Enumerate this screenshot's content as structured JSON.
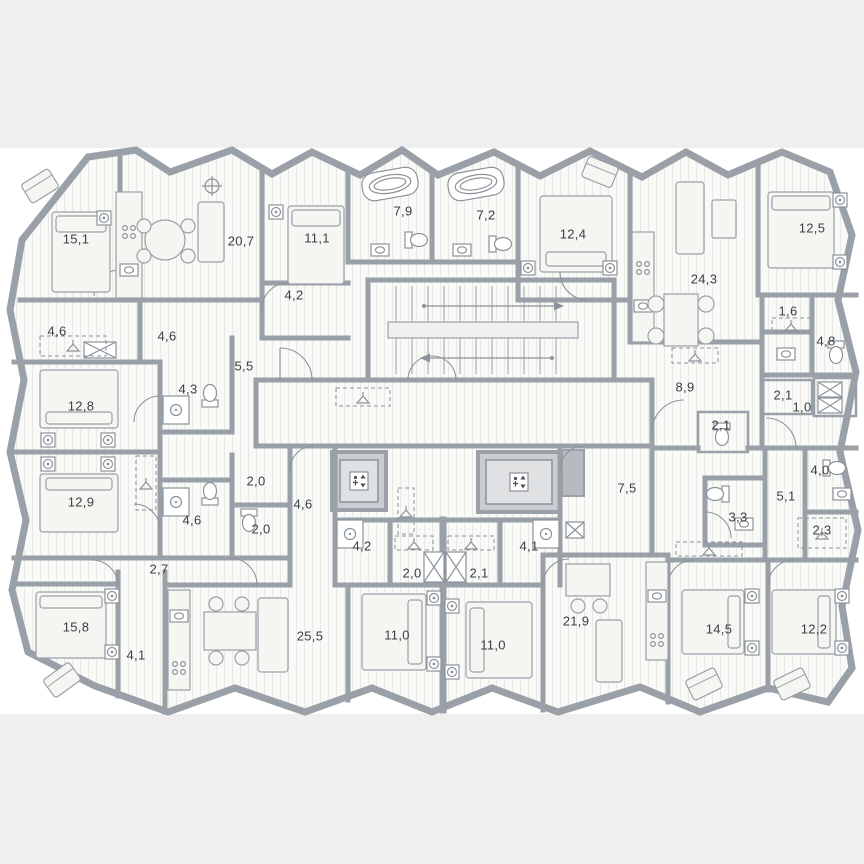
{
  "plan": {
    "type": "residential-floor-plan",
    "colors": {
      "background": "#efefef",
      "paper": "#ffffff",
      "wall": "#99a0a7",
      "floor": "#f9f9f7",
      "floor_stripe": "#e8e8e5",
      "corridor": "#dcdee1",
      "corridor_grid": "#d2d5d9",
      "furniture_fill": "#f5f5f2",
      "fixture_stroke": "#8c939a",
      "label": "#3a3f45"
    },
    "icons": {
      "elevator": "elevator-icon",
      "staircase": "staircase-icon",
      "bathtub": "bathtub-icon",
      "shower": "shower-icon",
      "toilet": "toilet-icon",
      "washbasin": "washbasin-icon",
      "stove": "stove-burners-icon",
      "wardrobe": "hanger-icon",
      "shaft": "crossed-shaft-icon",
      "ceiling_light": "ceiling-light-icon"
    },
    "rooms": [
      {
        "area": "15,1",
        "x": 76,
        "y": 240
      },
      {
        "area": "20,7",
        "x": 241,
        "y": 242
      },
      {
        "area": "11,1",
        "x": 317,
        "y": 239
      },
      {
        "area": "7,9",
        "x": 403,
        "y": 212
      },
      {
        "area": "7,2",
        "x": 486,
        "y": 216
      },
      {
        "area": "12,4",
        "x": 573,
        "y": 235
      },
      {
        "area": "24,3",
        "x": 704,
        "y": 280
      },
      {
        "area": "12,5",
        "x": 812,
        "y": 229
      },
      {
        "area": "4,6",
        "x": 57,
        "y": 332
      },
      {
        "area": "4,6",
        "x": 167,
        "y": 337
      },
      {
        "area": "4,2",
        "x": 294,
        "y": 296
      },
      {
        "area": "5,5",
        "x": 244,
        "y": 367
      },
      {
        "area": "4,3",
        "x": 188,
        "y": 390
      },
      {
        "area": "1,6",
        "x": 788,
        "y": 312
      },
      {
        "area": "4,8",
        "x": 826,
        "y": 342
      },
      {
        "area": "12,8",
        "x": 81,
        "y": 407
      },
      {
        "area": "8,9",
        "x": 685,
        "y": 388
      },
      {
        "area": "2,1",
        "x": 783,
        "y": 396
      },
      {
        "area": "1,0",
        "x": 802,
        "y": 408
      },
      {
        "area": "2,1",
        "x": 721,
        "y": 426
      },
      {
        "area": "12,9",
        "x": 81,
        "y": 503
      },
      {
        "area": "2,0",
        "x": 256,
        "y": 482
      },
      {
        "area": "4,6",
        "x": 192,
        "y": 521
      },
      {
        "area": "2,0",
        "x": 261,
        "y": 530
      },
      {
        "area": "4,6",
        "x": 303,
        "y": 505
      },
      {
        "area": "7,5",
        "x": 627,
        "y": 489
      },
      {
        "area": "4,0",
        "x": 820,
        "y": 471
      },
      {
        "area": "5,1",
        "x": 786,
        "y": 497
      },
      {
        "area": "3,3",
        "x": 738,
        "y": 518
      },
      {
        "area": "2,3",
        "x": 822,
        "y": 531
      },
      {
        "area": "2,7",
        "x": 159,
        "y": 570
      },
      {
        "area": "4,2",
        "x": 362,
        "y": 547
      },
      {
        "area": "2,0",
        "x": 412,
        "y": 574
      },
      {
        "area": "2,1",
        "x": 479,
        "y": 574
      },
      {
        "area": "4,1",
        "x": 529,
        "y": 547
      },
      {
        "area": "15,8",
        "x": 76,
        "y": 628
      },
      {
        "area": "4,1",
        "x": 136,
        "y": 656
      },
      {
        "area": "25,5",
        "x": 310,
        "y": 637
      },
      {
        "area": "11,0",
        "x": 397,
        "y": 636
      },
      {
        "area": "11,0",
        "x": 493,
        "y": 646
      },
      {
        "area": "21,9",
        "x": 576,
        "y": 622
      },
      {
        "area": "14,5",
        "x": 719,
        "y": 630
      },
      {
        "area": "12,2",
        "x": 814,
        "y": 630
      }
    ]
  }
}
